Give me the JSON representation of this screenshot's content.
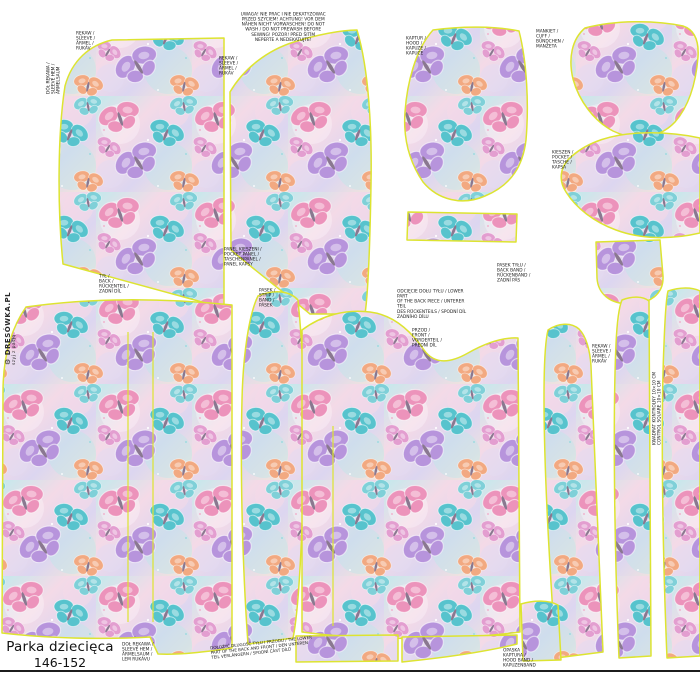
{
  "panel": {
    "title": "Parka dziecięca",
    "size": "146-152",
    "brand": "DRESÓWKA.PL",
    "brand_tagline": "szyj z pasją",
    "brand_icon": "⚙"
  },
  "colors": {
    "piece_outline": "#dde431",
    "cut_line": "#1c1c1c",
    "text": "#1a1a1a",
    "fabric_palette": [
      "#ec93bb",
      "#57c3cd",
      "#b794dc",
      "#f2a981",
      "#e39ed0",
      "#7fd0d8"
    ]
  },
  "warning_note": "UWAGA! NIE PRAĆ I NIE DEKATYZOWAĆ\nPRZED SZYCIEM! ACHTUNG! VOR DEM\nNÄHEN NICHT VORWASCHEN! DO NOT\nWASH / DO NOT PREWASH BEFORE\nSEWING! POZOR! PŘED ŠITÍM\nNEPERTE A NEDEKATUJTE!",
  "piece_labels": {
    "sleeve_left": "RĘKAW /\nSLEEVE /\nÄRMEL /\nRUKÁV",
    "sleeve_front_top": "RĘKAW /\nSLEEVE /\nÄRMEL /\nRUKÁV",
    "hood": "KAPTUR /\nHOOD /\nKAPUZE /\nKAPUCE",
    "cuff": "MANKIET /\nCUFF /\nBÜNDCHEN /\nMANŽETA",
    "pocket": "KIESZEŃ /\nPOCKET /\nTASCHE /\nKAPSA",
    "back": "TYŁ /\nBACK /\nRÜCKENTEIL /\nZADNÍ DÍL",
    "pocket_panel": "PANEL KIESZENI /\nPOCKET PANEL /\nTASCHENPANEL /\nPANEL KAPSY",
    "strip": "PASEK /\nSTRIP /\nBAND /\nPÁSEK",
    "back_cut_note": "ODCIĘCIE DOŁU TYŁU / LOWER PART\nOF THE BACK PIECE / UNTERER TEIL\nDES RÜCKENTEILS / SPODNÍ DÍL\nZADNÍHO DÍLU",
    "back_band": "PASEK TYŁU /\nBACK BAND /\nRÜCKENBAND /\nZADNÍ PÁS",
    "front": "PRZÓD /\nFRONT /\nVORDERTEIL /\nPŘEDNÍ DÍL",
    "sleeve_right": "RĘKAW /\nSLEEVE /\nÄRMEL /\nRUKÁV",
    "control_square": "KWADRAT KONTROLNY 10×10 CM\nCONTROL SQUARE 10×10 CM",
    "sleeve_hem": "DÓŁ RĘKAWA /\nSLEEVE HEM /\nÄRMELSAUM /\nLEM RUKÁVU",
    "lengthen_note": "DOŁOŻYĆ DŁUGOŚĆ TYŁU I PRZODU / THE LOWER\nPART OF THE BACK AND FRONT / DEN UNTEREN\nTEIL VERLÄNGERN / SPODNÍ ČÁST DÍLŮ",
    "hood_band": "OPASKA\nKAPTURA /\nHOOD BAND /\nKAPUZENBAND",
    "print_edge_note": "DÓŁ RĘKAWA /\nSLEEVE HEM /\nÄRMELSAUM"
  }
}
